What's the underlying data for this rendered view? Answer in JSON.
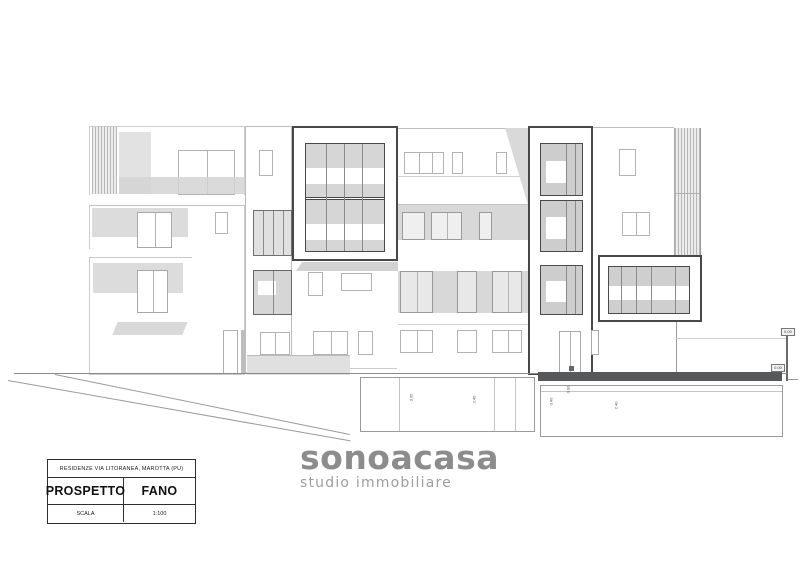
{
  "title_block": {
    "project": "RESIDENZE VIA LITORANEA, MAROTTA (PU)",
    "drawing_type": "PROSPETTO",
    "location": "FANO",
    "scale_label": "SCALA",
    "scale_value": "1:100"
  },
  "logo": {
    "name": "sonoacasa",
    "tagline": "studio immobiliare",
    "name_color": "#8c8c8c",
    "tagline_color": "#9e9e9e"
  },
  "drawing": {
    "description": "front elevation of a residential building with balconies, stacked window boxes and underground garage",
    "dimensions": [
      "3.05",
      "2.40",
      "0.40",
      "2.40"
    ],
    "levels": [
      "0.00",
      "0.00",
      "0.00"
    ],
    "colors": {
      "outline_dark": "#47484a",
      "outline_faint": "#c6c6c6",
      "fill_light": "#e2e2e2",
      "fill_mid": "#d8d8d8",
      "deck_bar": "#57585b"
    }
  }
}
